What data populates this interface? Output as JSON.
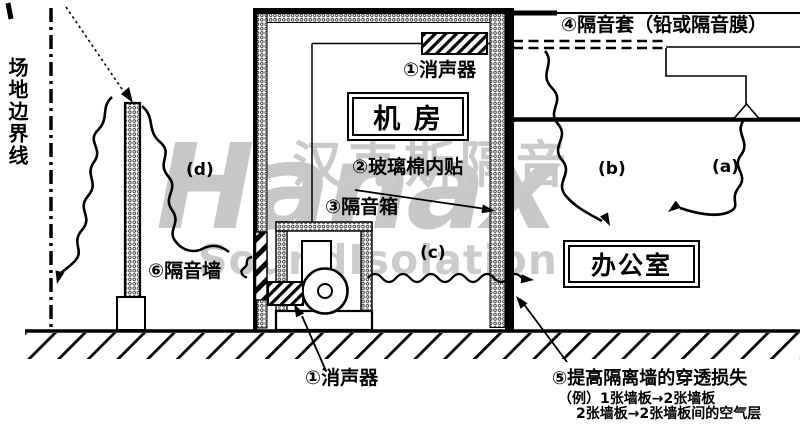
{
  "title": "噪声控制措施示意图",
  "watermark": {
    "logo": "Hanax",
    "cn": "汉克斯隔音",
    "en": "SoundIsolation",
    "color": "#c8c8c8"
  },
  "colors": {
    "ink": "#000000",
    "background": "#ffffff"
  },
  "labels": {
    "site_boundary": "场地边界线",
    "silencer_top": "①消声器",
    "machine_room": "机 房",
    "glass_wool": "②玻璃棉内贴",
    "sound_box": "③隔音箱",
    "jacket": "④隔音套（铅或隔音膜）",
    "office": "办公室",
    "wall": "⑥隔音墙",
    "silencer_bottom": "①消声器",
    "item5_title": "⑤提高隔离墙的穿透损失",
    "item5_example1": "（例）1张墙板→2张墙板",
    "item5_example2": "2张墙板→2张墙板间的空气层",
    "path_a": "(a)",
    "path_b": "(b)",
    "path_c": "(c)",
    "path_d": "(d)"
  }
}
